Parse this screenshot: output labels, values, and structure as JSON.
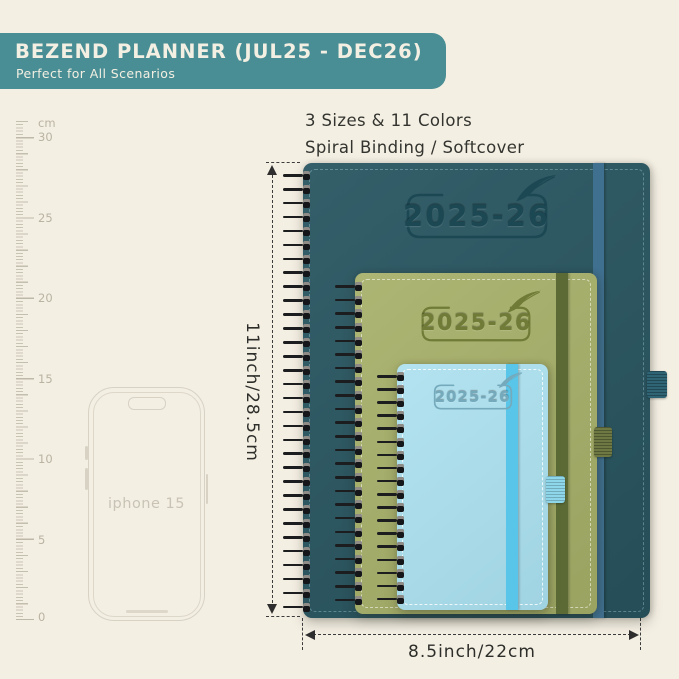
{
  "banner": {
    "title": "BEZEND PLANNER (JUL25 - DEC26)",
    "subtitle": "Perfect for All Scenarios",
    "bg_color": "#4a8e95",
    "text_color": "#f3efe2"
  },
  "info": {
    "line1": "3 Sizes & 11 Colors",
    "line2": "Spiral Binding / Softcover"
  },
  "ruler": {
    "unit": "cm",
    "labels": [
      "30",
      "25",
      "20",
      "15",
      "10",
      "5",
      "0"
    ]
  },
  "phone": {
    "label": "iphone 15"
  },
  "planners": {
    "large": {
      "year": "2025-26",
      "cover_color": "#295661",
      "band_color": "#40708f"
    },
    "medium": {
      "year": "2025-26",
      "cover_color": "#a6af68",
      "band_color": "#5c6b36"
    },
    "small": {
      "year": "2025-26",
      "cover_color": "#a9dfee",
      "band_color": "#58c5e9"
    }
  },
  "dimensions": {
    "height_label": "11inch/28.5cm",
    "width_label": "8.5inch/22cm"
  },
  "colors": {
    "background": "#f4efe3",
    "dimension_text": "#2d2e2a",
    "ruler_marks": "#c9c3b4"
  }
}
